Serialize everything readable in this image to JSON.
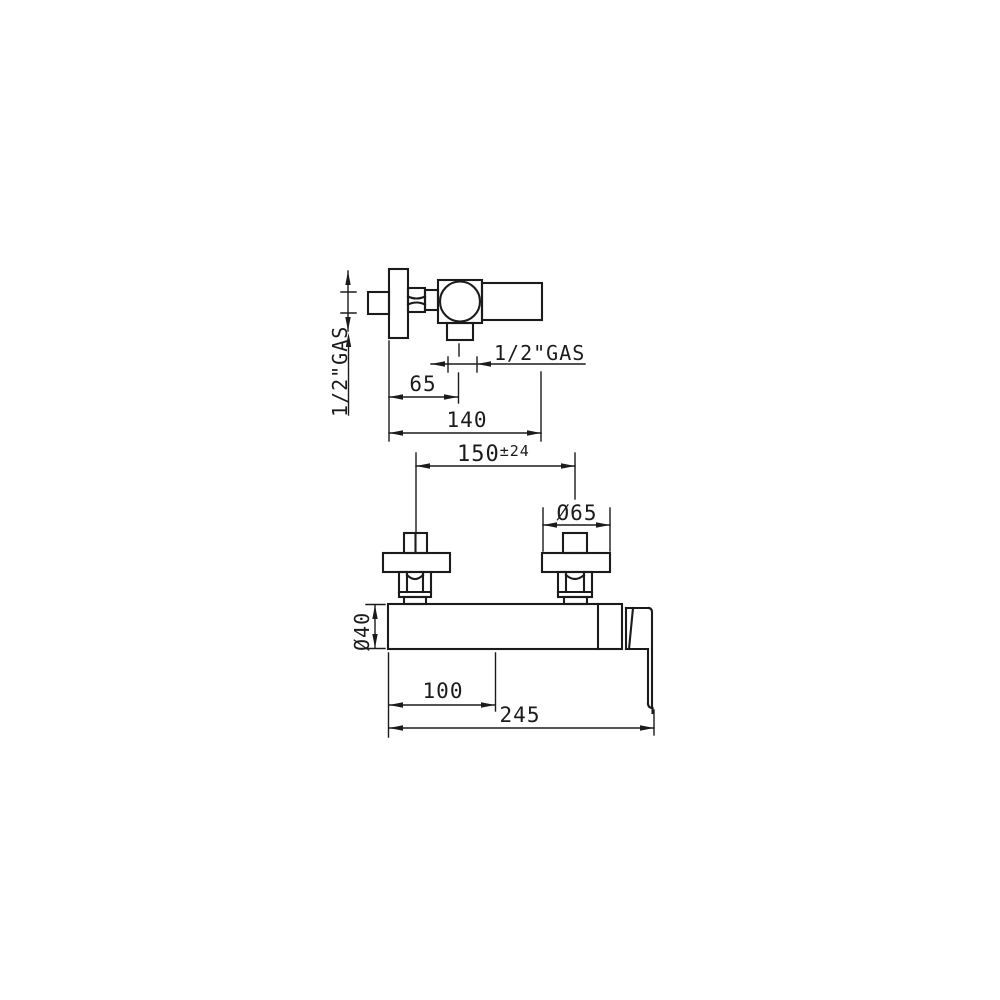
{
  "colors": {
    "line": "#1b1b1b",
    "background": "#ffffff"
  },
  "side_view": {
    "inlet_gas_label": "1/2\"GAS",
    "outlet_gas_label": "1/2\"GAS",
    "dim_outlet_offset": "65",
    "dim_total_depth": "140"
  },
  "front_view": {
    "dim_centers_value": "150",
    "dim_centers_tolerance": "±24",
    "dim_flange_diameter": "Ø65",
    "dim_body_diameter": "Ø40",
    "dim_outlet_position": "100",
    "dim_total_width": "245"
  }
}
